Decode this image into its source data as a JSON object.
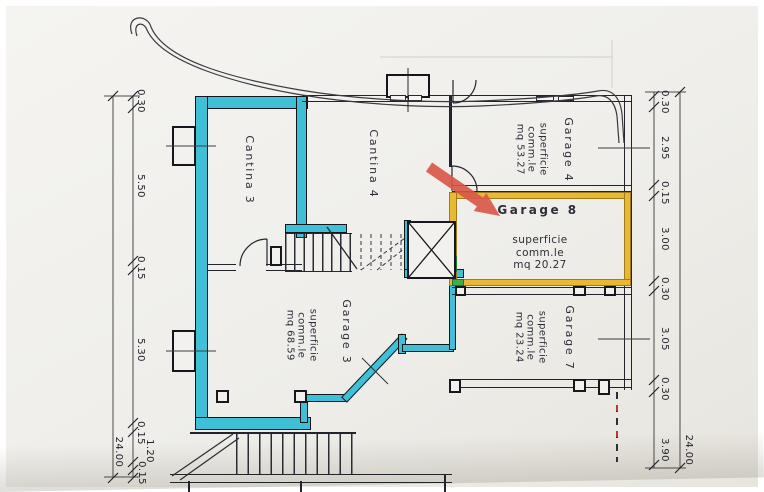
{
  "document": {
    "kind": "cadastral floor plan scan",
    "language": "italian"
  },
  "rooms": {
    "cantina3": {
      "label": "Cantina 3"
    },
    "cantina4": {
      "label": "Cantina 4"
    },
    "garage4": {
      "label": "Garage 4",
      "area": [
        "superficie",
        "comm.le",
        "mq 53.27"
      ]
    },
    "garage8": {
      "label": "Garage 8",
      "area": [
        "superficie",
        "comm.le",
        "mq 20.27"
      ]
    },
    "garage7": {
      "label": "Garage 7",
      "area": [
        "superficie",
        "comm.le",
        "mq 23.24"
      ]
    },
    "garage3": {
      "label": "Garage 3",
      "area": [
        "superficie",
        "comm.le",
        "mq 68.59"
      ]
    }
  },
  "dimensions": {
    "left": {
      "segments": [
        "0.30",
        "5.50",
        "0.15",
        "5.30",
        "0.15",
        "1.20",
        "0.15"
      ],
      "total": "24.00"
    },
    "right": {
      "segments": [
        "0.30",
        "2.95",
        "0.15",
        "3.00",
        "0.30",
        "3.05",
        "0.30",
        "3.90"
      ],
      "total": "24.00"
    }
  },
  "annotation": {
    "arrow_target": "Garage 8"
  },
  "colors": {
    "wall_cyan": "#3fc0d6",
    "highlight_yellow": "#eab933",
    "highlight_green": "#3fae4e",
    "arrow_red": "#d95447",
    "line_dark": "#23232c",
    "paper": "#f0efeb"
  }
}
